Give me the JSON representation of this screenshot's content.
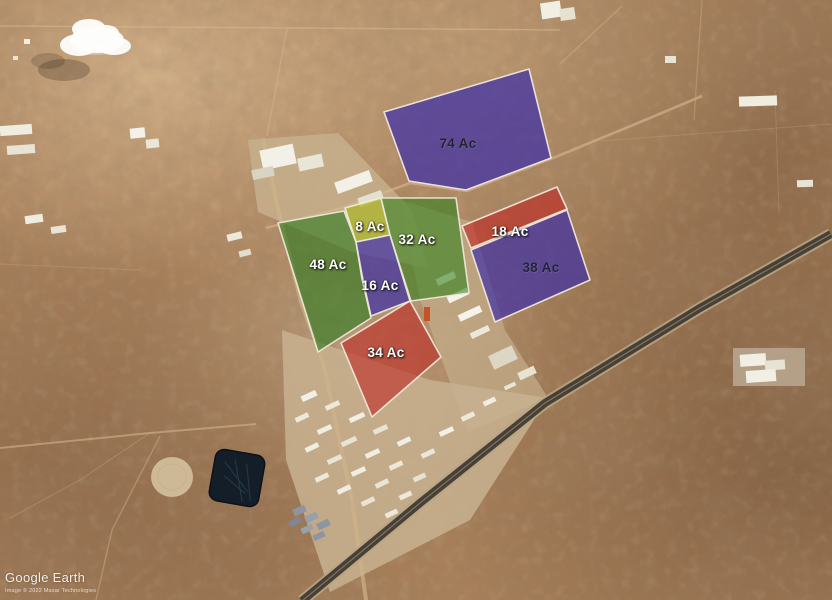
{
  "watermark": {
    "brand": "Google Earth",
    "attribution": "Image © 2022 Maxar Technologies"
  },
  "parcels": [
    {
      "id": "parcel-74",
      "label": "74 Ac",
      "acres": 74,
      "fill": "#3a2ca8",
      "fill_opacity": 0.7,
      "stroke": "#f3e9e2",
      "label_color": "#23232e",
      "label_style": "dark",
      "points": "384,112 529,69 551,158 466,190 409,181",
      "label_x": 458,
      "label_y": 148
    },
    {
      "id": "parcel-48",
      "label": "48 Ac",
      "acres": 48,
      "fill": "#2f7a21",
      "fill_opacity": 0.62,
      "stroke": "#eee9da",
      "label_color": "#ffffff",
      "label_style": "light",
      "points": "278,223 344,211 356,242 362,279 371,318 318,352",
      "label_x": 328,
      "label_y": 269
    },
    {
      "id": "parcel-8",
      "label": "8 Ac",
      "acres": 8,
      "fill": "#adb626",
      "fill_opacity": 0.7,
      "stroke": "#f2eddd",
      "label_color": "#ffffff",
      "label_style": "light",
      "points": "345,208 381,198 390,235 356,242",
      "label_x": 370,
      "label_y": 231
    },
    {
      "id": "parcel-32",
      "label": "32 Ac",
      "acres": 32,
      "fill": "#35821f",
      "fill_opacity": 0.6,
      "stroke": "#eee9da",
      "label_color": "#ffffff",
      "label_style": "light",
      "points": "381,198 456,198 469,293 411,301 390,235",
      "label_x": 417,
      "label_y": 244
    },
    {
      "id": "parcel-16",
      "label": "16 Ac",
      "acres": 16,
      "fill": "#3a2ca8",
      "fill_opacity": 0.68,
      "stroke": "#eee9da",
      "label_color": "#ffffff",
      "label_style": "light",
      "points": "356,242 390,235 410,301 371,316 363,280",
      "label_x": 380,
      "label_y": 290
    },
    {
      "id": "parcel-18",
      "label": "18 Ac",
      "acres": 18,
      "fill": "#be2823",
      "fill_opacity": 0.62,
      "stroke": "#f2e8dc",
      "label_color": "#ffffff",
      "label_style": "light",
      "points": "462,226 557,187 567,209 471,248",
      "label_x": 510,
      "label_y": 236
    },
    {
      "id": "parcel-38",
      "label": "38 Ac",
      "acres": 38,
      "fill": "#3a2ca8",
      "fill_opacity": 0.68,
      "stroke": "#f2e8dc",
      "label_color": "#23233a",
      "label_style": "dark",
      "points": "471,250 567,210 590,280 495,322",
      "label_x": 541,
      "label_y": 272
    },
    {
      "id": "parcel-34",
      "label": "34 Ac",
      "acres": 34,
      "fill": "#be2823",
      "fill_opacity": 0.6,
      "stroke": "#f2e8dc",
      "label_color": "#ffffff",
      "label_style": "light",
      "points": "410,301 441,357 372,417 341,343",
      "label_x": 386,
      "label_y": 357
    }
  ]
}
